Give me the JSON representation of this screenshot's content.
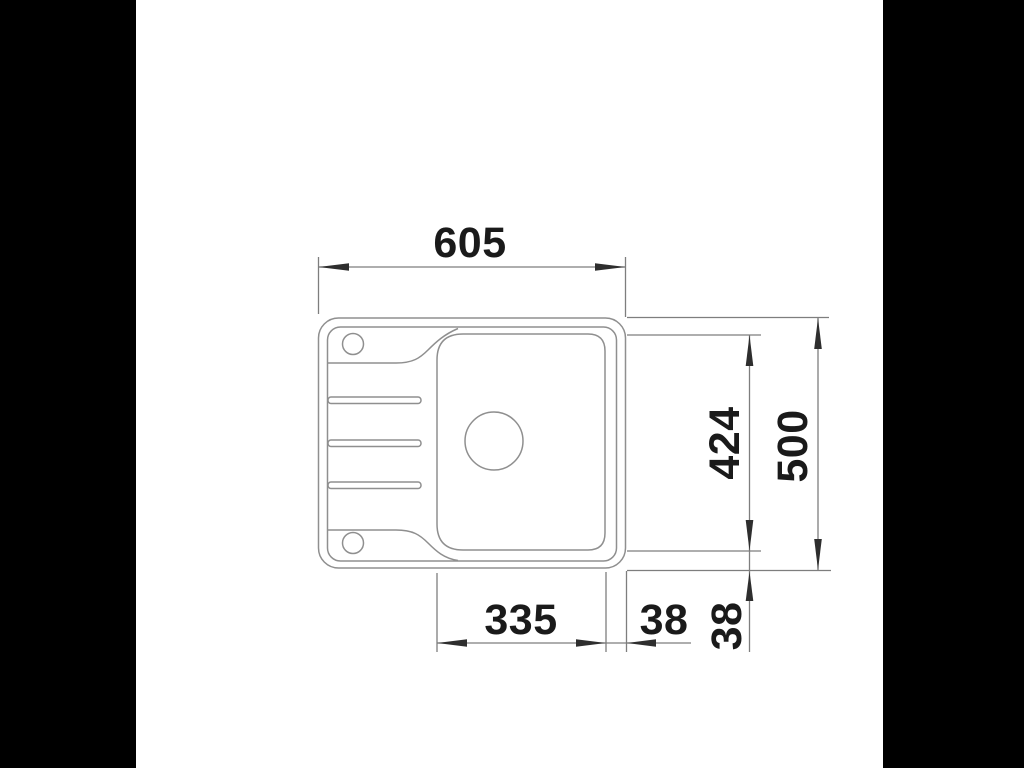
{
  "scene": {
    "description": "Technical top-view dimension drawing of a kitchen sink with one bowl, left drainboard, two tap holes and a central drain",
    "background_color": "#ffffff",
    "letterbox_color": "#000000"
  },
  "drawing_style": {
    "outline_color": "#8f8f8f",
    "dimension_line_color": "#7e7e7e",
    "arrow_color": "#2e2e2e",
    "label_color": "#1a1a1a"
  },
  "dimensions": {
    "overall_width": "605",
    "overall_depth": "500",
    "bowl_depth": "424",
    "bowl_width": "335",
    "right_offset": "38",
    "bottom_offset": "38"
  }
}
